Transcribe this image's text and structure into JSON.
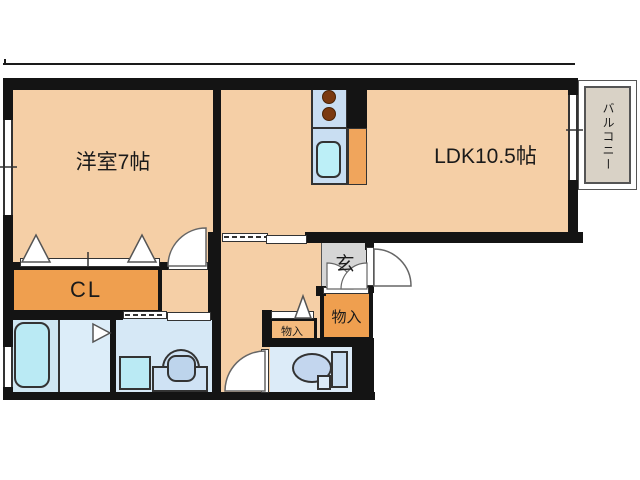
{
  "plan": {
    "title": "apartment-floor-plan",
    "rooms": [
      {
        "id": "western-room",
        "label": "洋室7帖"
      },
      {
        "id": "ldk",
        "label": "LDK10.5帖"
      },
      {
        "id": "closet",
        "label": "CL"
      },
      {
        "id": "entrance",
        "label": "玄"
      },
      {
        "id": "storage-large",
        "label": "物入"
      },
      {
        "id": "storage-small",
        "label": "物入"
      },
      {
        "id": "balcony",
        "label": "バルコニー"
      }
    ],
    "fixtures": [
      "bathtub",
      "washing-machine",
      "vanity-sink",
      "toilet",
      "kitchen-counter",
      "stove-burners",
      "kitchen-sink"
    ],
    "colors": {
      "floor_peach": "#f5cfa6",
      "storage_orange": "#ef9f4f",
      "storage_light_orange": "#f4ba7d",
      "kitchen_orange": "#f0a55c",
      "entrance_gray": "#d6d6d6",
      "balcony_gray": "#d9d2c6",
      "wall_black": "#141414",
      "water_cyan": "#baeaf4",
      "tile_blue": "#d6e8f6",
      "counter_blue": "#c9def2"
    }
  }
}
